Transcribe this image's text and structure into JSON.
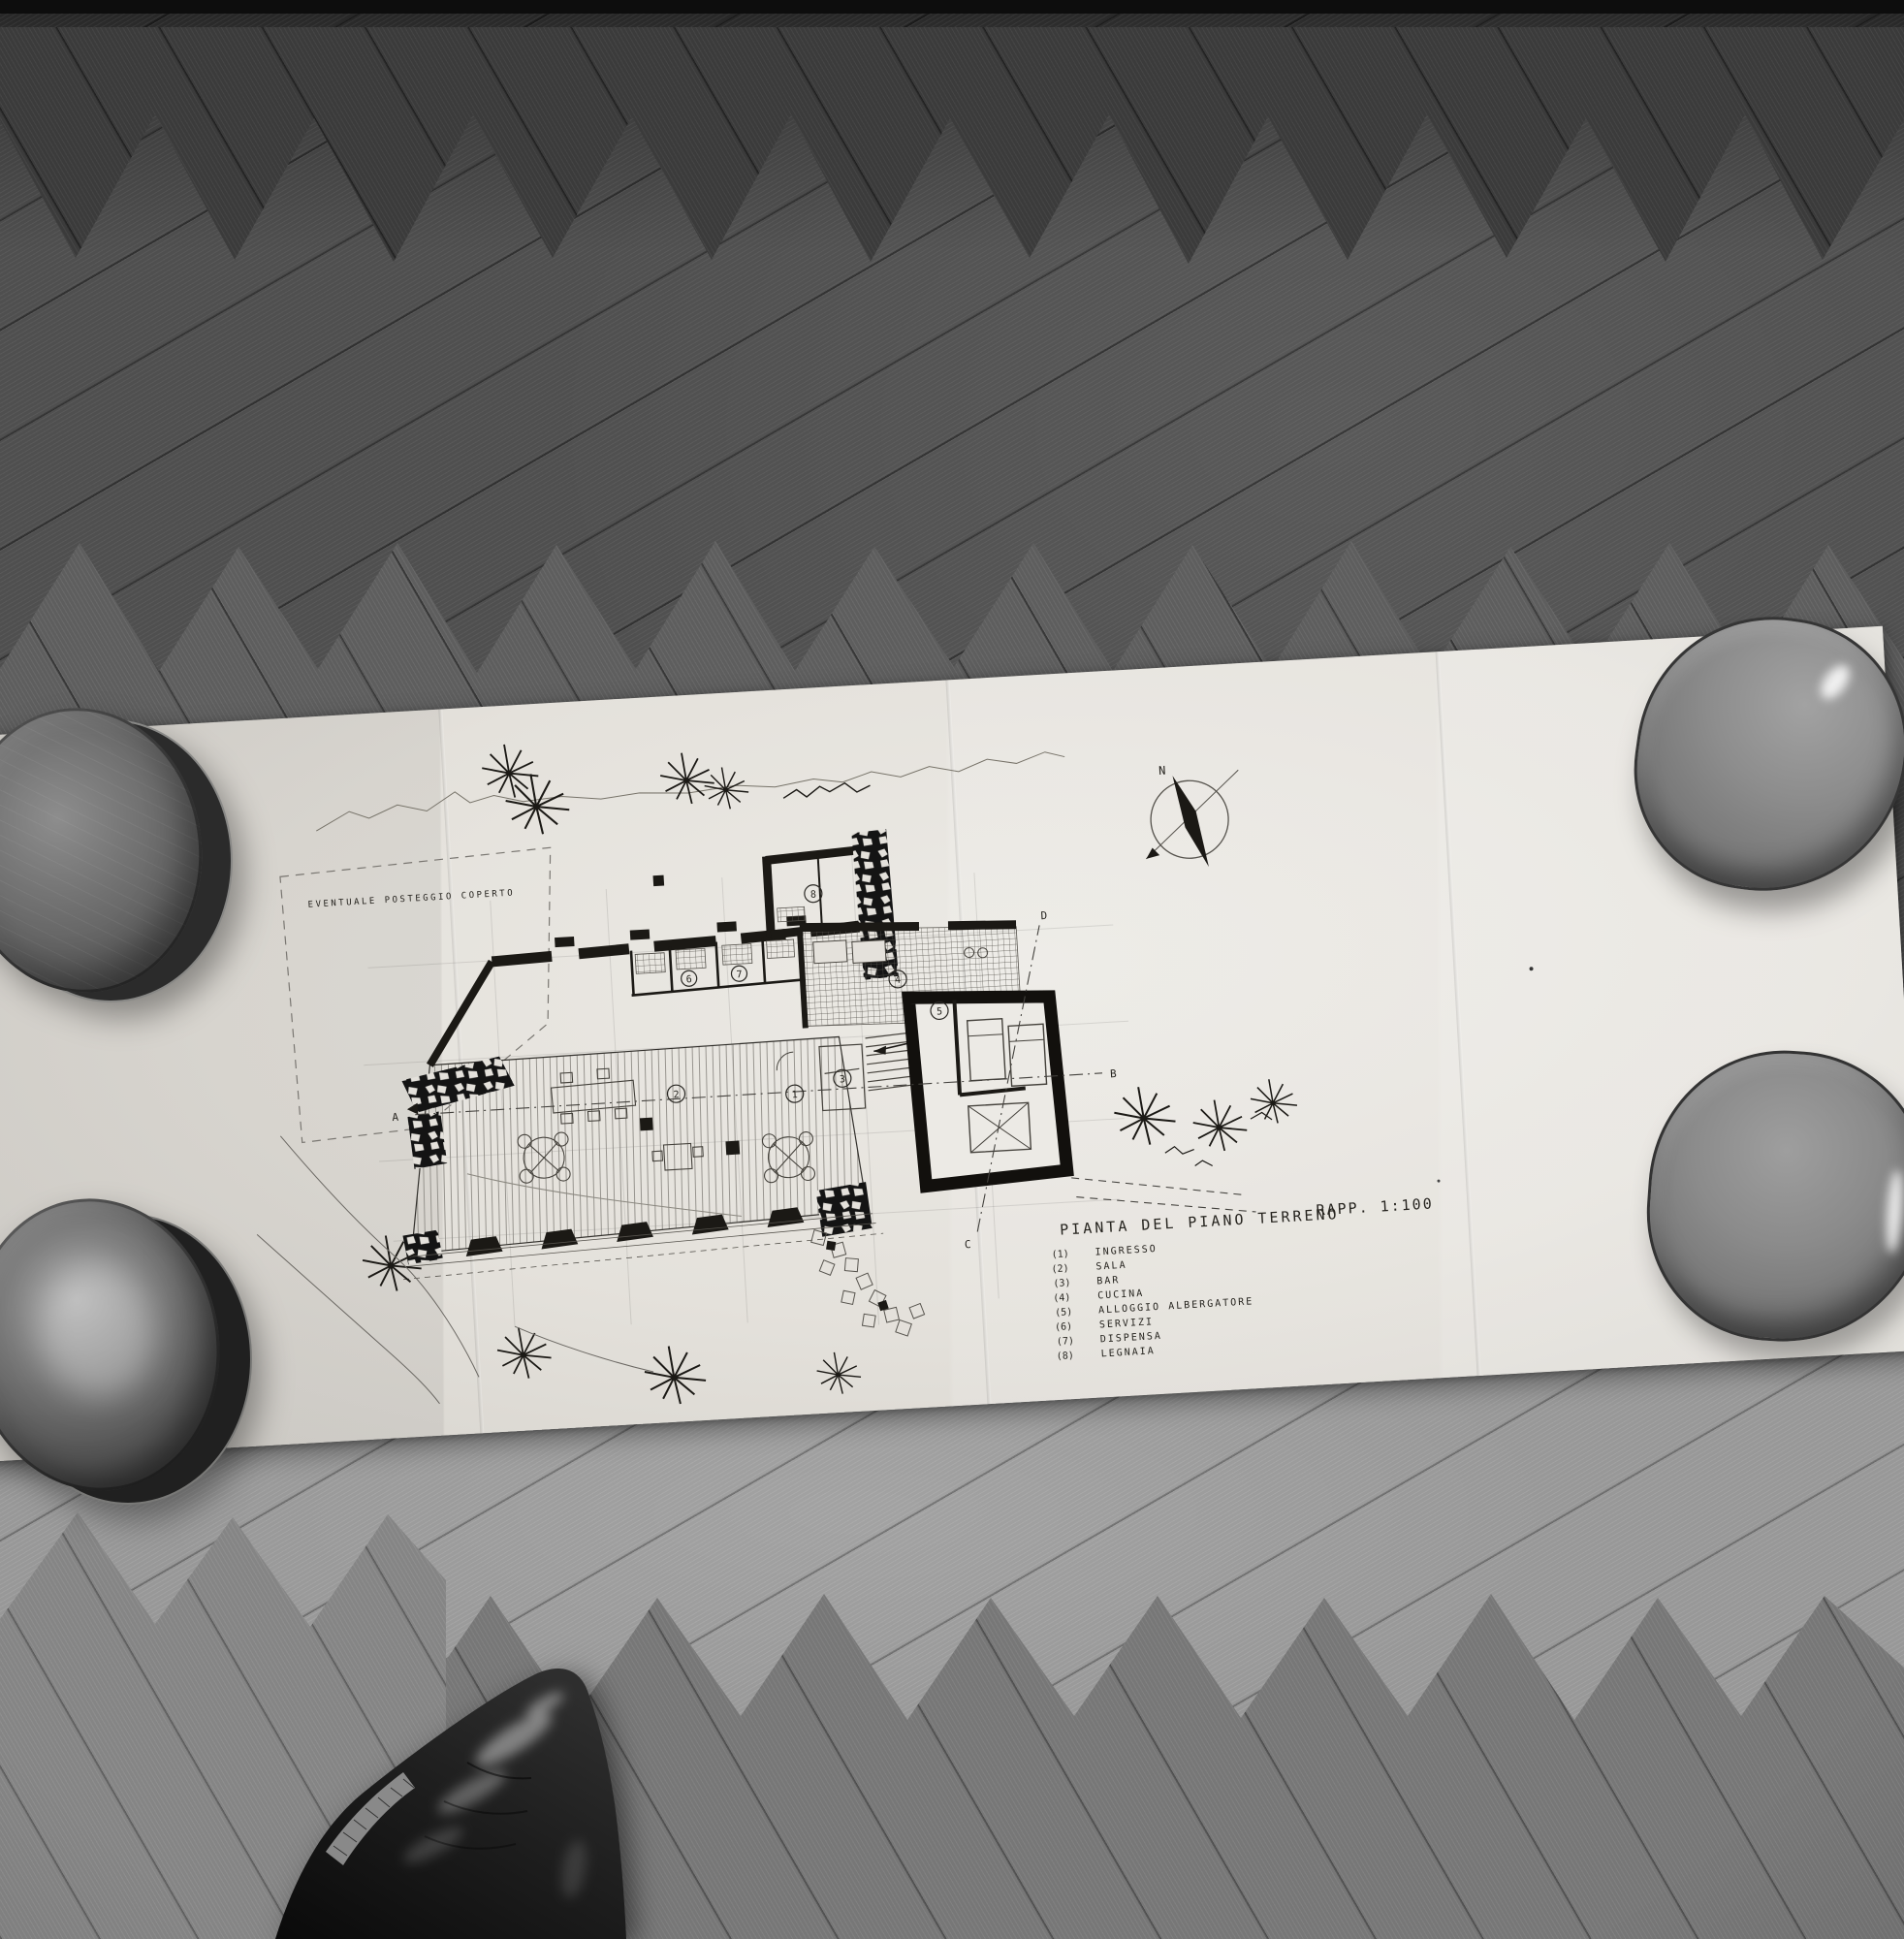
{
  "drawing": {
    "title": "PIANTA DEL PIANO TERRENO",
    "scale_label": "RAPP. 1:100",
    "site_note": "EVENTUALE POSTEGGIO COPERTO",
    "compass_north_label": "N",
    "legend": {
      "items": [
        {
          "num": "(1)",
          "label": "INGRESSO"
        },
        {
          "num": "(2)",
          "label": "SALA"
        },
        {
          "num": "(3)",
          "label": "BAR"
        },
        {
          "num": "(4)",
          "label": "CUCINA"
        },
        {
          "num": "(5)",
          "label": "ALLOGGIO ALBERGATORE"
        },
        {
          "num": "(6)",
          "label": "SERVIZI"
        },
        {
          "num": "(7)",
          "label": "DISPENSA"
        },
        {
          "num": "(8)",
          "label": "LEGNAIA"
        }
      ]
    },
    "room_markers": [
      "1",
      "2",
      "3",
      "4",
      "5",
      "6",
      "7",
      "8"
    ],
    "section_markers": [
      "A",
      "B",
      "C",
      "D"
    ]
  },
  "colors": {
    "paper": "#e4e1db",
    "ink": "#1b1915",
    "pencil": "#6b6863",
    "floor_dark": "#4f4f4f",
    "floor_light": "#989898",
    "bowl_gray": "#8d8d8d",
    "plate_dark": "#454545",
    "shoe_black": "#141414"
  }
}
